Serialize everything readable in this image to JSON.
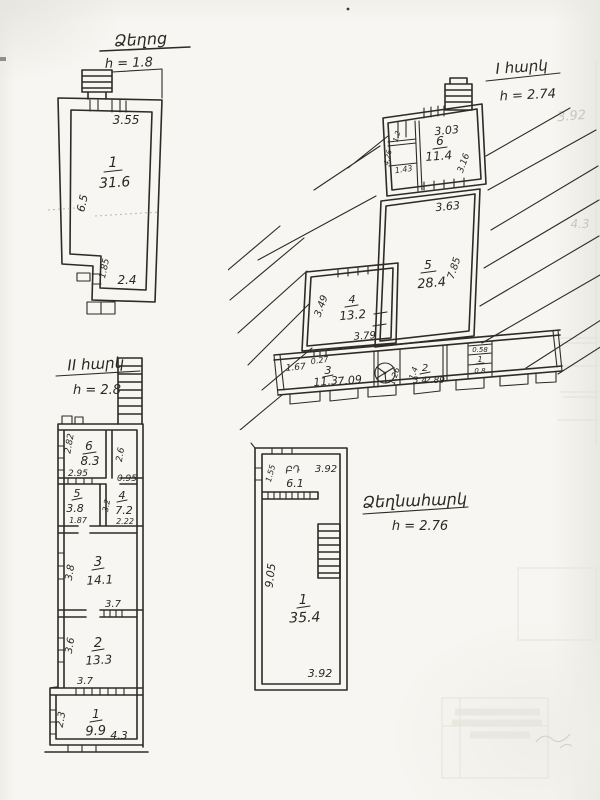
{
  "page": {
    "background": "#f7f6f2",
    "ink": "#2e2b24",
    "ghost_ink": "#c7c7be"
  },
  "plan_attic": {
    "title": "Ձեղոց",
    "height_note": "h = 1.8",
    "room1": {
      "number": "1",
      "area": "31.6"
    },
    "dims": {
      "top": "3.55",
      "left_side": "6.5",
      "notch": "1.85",
      "bottom": "2.4"
    }
  },
  "plan_floor1": {
    "title": "I հարկ",
    "height_note": "h = 2.74",
    "room6": {
      "number": "6",
      "area": "11.4",
      "dim_top": "3.03",
      "dim_right": "3.16"
    },
    "annex": {
      "dim_a": "1.2",
      "dim_b": "1.43",
      "dim_c": "4.26"
    },
    "room5": {
      "number": "5",
      "area": "28.4",
      "dim_top": "3.63",
      "dim_right": "7.85"
    },
    "room4": {
      "number": "4",
      "area": "13.2",
      "dim_left": "3.49",
      "dim_bottom": "3.79"
    },
    "room3": {
      "number": "3",
      "area": "11.3",
      "dim_left": "1.67",
      "dim_top": "0.27",
      "dim_bottom": "7.09"
    },
    "fan_dim": "1.26",
    "room2": {
      "number": "2",
      "area": "3.4",
      "dim_left": "1.4",
      "dim_bottom": "2.89"
    },
    "room1": {
      "number": "1",
      "dim_top": "0.58",
      "dim_bottom": "0.8"
    }
  },
  "plan_floor2": {
    "title": "II հարկ",
    "height_note": "h = 2.8",
    "room6": {
      "number": "6",
      "area": "8.3",
      "dim_left": "2.82",
      "dim_bottom": "2.95"
    },
    "corridor": {
      "dim_side": "2.6",
      "dim_bottom": "0.95"
    },
    "room5": {
      "number": "5",
      "area": "3.8",
      "dim_bottom": "1.87"
    },
    "room4": {
      "number": "4",
      "area": "7.2",
      "dim_side": "3.2",
      "dim_bottom": "2.22"
    },
    "room3": {
      "number": "3",
      "area": "14.1",
      "dim_left": "3.8",
      "dim_bottom": "3.7"
    },
    "room2": {
      "number": "2",
      "area": "13.3",
      "dim_left": "3.6",
      "dim_bottom": "3.7"
    },
    "room1": {
      "number": "1",
      "area": "9.9",
      "dim_left": "2.3",
      "dim_bottom": "4.3"
    }
  },
  "plan_attic_large": {
    "title": "Ձեղնահարկ",
    "height_note": "h = 2.76",
    "room_top": {
      "label": "ԲԴ",
      "area": "6.1",
      "dim_top": "3.92",
      "dim_left": "1.55"
    },
    "room1": {
      "number": "1",
      "area": "35.4",
      "dim_left": "9.05",
      "dim_bottom": "3.92"
    }
  },
  "ghosts": {
    "num_a": "3.92",
    "num_b": "4.3"
  }
}
